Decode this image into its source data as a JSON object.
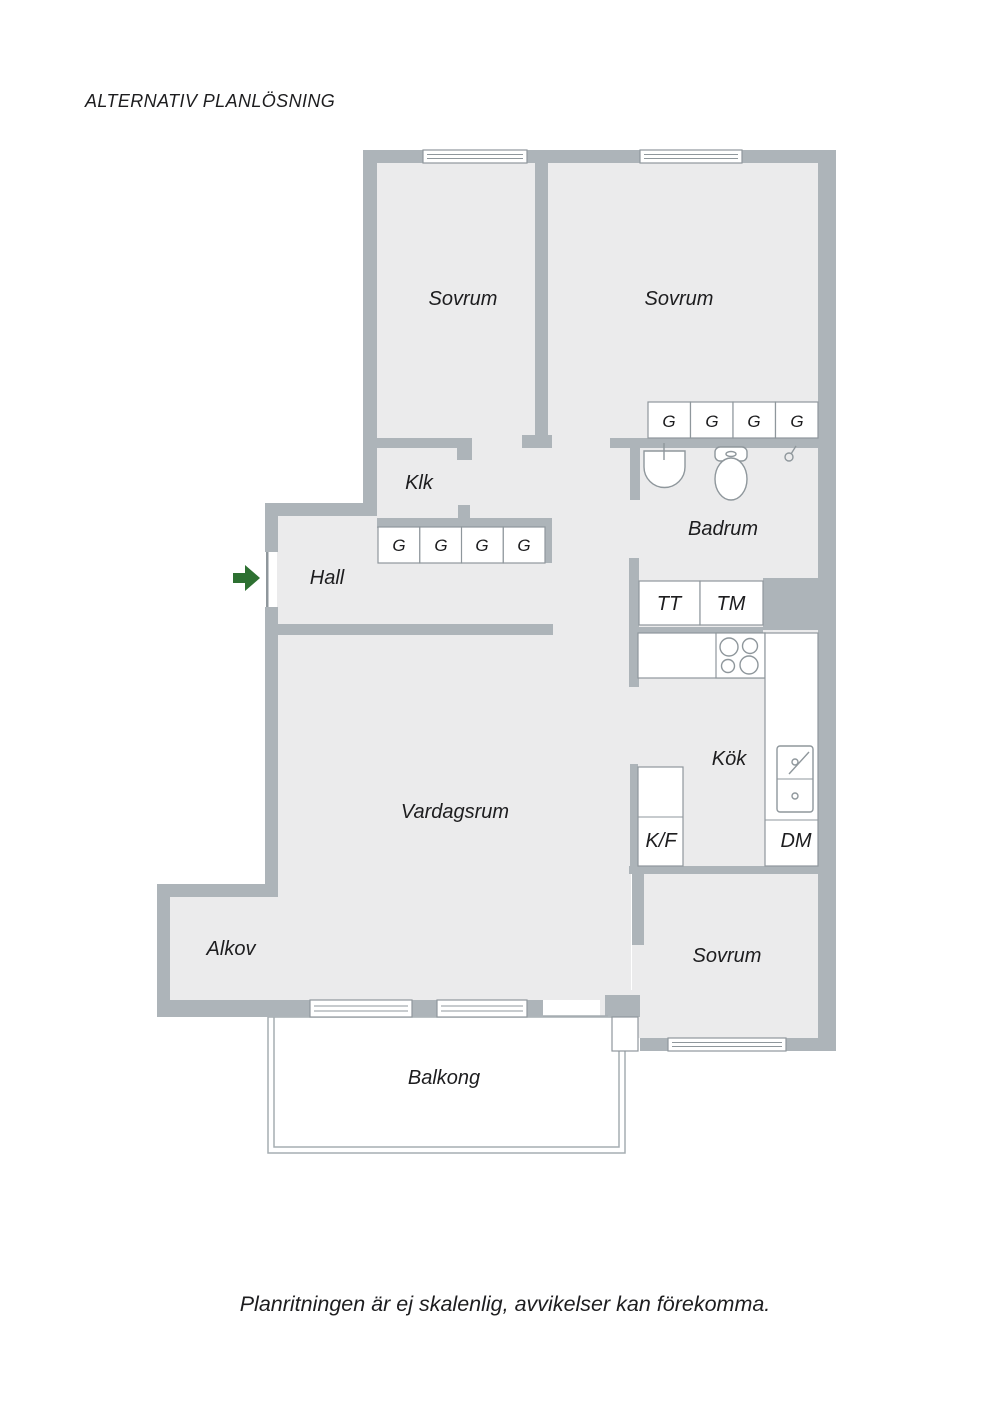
{
  "page": {
    "title": "ALTERNATIV PLANLÖSNING",
    "caption": "Planritningen är ej skalenlig, avvikelser kan förekomma."
  },
  "rooms": {
    "bedroom1": "Sovrum",
    "bedroom2": "Sovrum",
    "bedroom3": "Sovrum",
    "closet": "Klk",
    "hall": "Hall",
    "bathroom": "Badrum",
    "kitchen": "Kök",
    "living_room": "Vardagsrum",
    "alcove": "Alkov",
    "balcony": "Balkong"
  },
  "appliances": {
    "dryer": "TT",
    "washing_machine": "TM",
    "fridge_freezer": "K/F",
    "dishwasher": "DM"
  },
  "wardrobe": {
    "letter": "G",
    "hall_count": 4,
    "bedroom_count": 4
  },
  "colors": {
    "wall": "#adb4b9",
    "floor": "#ebebec",
    "line": "#8f979c",
    "arrow_green": "#2d7031",
    "text": "#1d1d1f"
  }
}
